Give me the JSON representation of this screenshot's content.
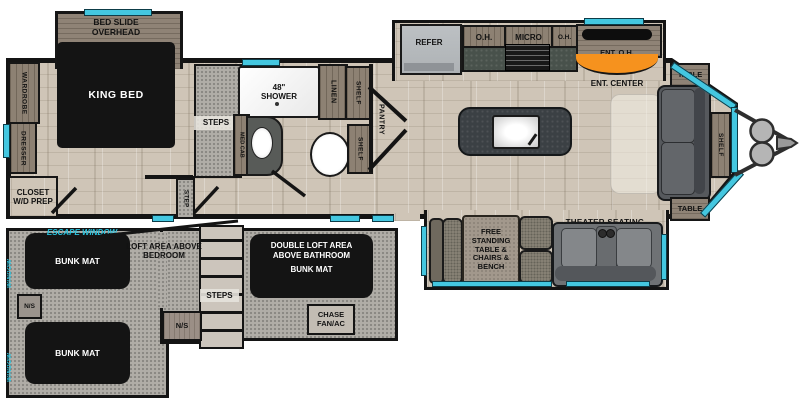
{
  "colors": {
    "window_glass": "#44c7e0",
    "ent_center_accent": "#f6921e",
    "floor_wood": "#cfc5b7",
    "loft_gray": "#b0ada7"
  },
  "bedroom": {
    "bed_slide_label": "BED SLIDE OVERHEAD",
    "king_bed_label": "KING BED",
    "wardrobe_label": "WARDROBE",
    "dresser_label": "DRESSER",
    "closet_label": "CLOSET W/D PREP",
    "steps_label": "STEPS",
    "step_label": "STEP"
  },
  "bathroom": {
    "shower_label": "48\" SHOWER",
    "med_cab_label": "MED CAB",
    "linen_label": "LINEN",
    "shelf_top_label": "SHELF",
    "shelf_bottom_label": "SHELF",
    "pantry_label": "PANTRY"
  },
  "kitchen": {
    "refer_label": "REFER",
    "oh_left_label": "O.H.",
    "micro_label": "MICRO",
    "oh_right_label": "O.H.",
    "ent_oh_label": "ENT. O.H.",
    "ent_center_label": "ENT. CENTER"
  },
  "living": {
    "table_top_label": "TABLE",
    "table_bottom_label": "TABLE",
    "shelf_label": "SHELF",
    "free_standing_label": "FREE STANDING TABLE & CHAIRS & BENCH",
    "theater_label": "THEATER SEATING"
  },
  "loft": {
    "escape_window_label": "ESCAPE WINDOW",
    "window_top_label": "WINDOW",
    "window_bottom_label": "WINDOW",
    "bunk_top_label": "BUNK MAT",
    "bunk_bottom_label": "BUNK MAT",
    "loft_area_label": "LOFT AREA ABOVE BEDROOM",
    "double_loft_label": "DOUBLE LOFT AREA ABOVE BATHROOM",
    "double_loft_bunk_label": "BUNK MAT",
    "steps_label": "STEPS",
    "ns_left_label": "N/S",
    "ns_right_label": "N/S",
    "chase_label": "CHASE FAN/AC"
  }
}
